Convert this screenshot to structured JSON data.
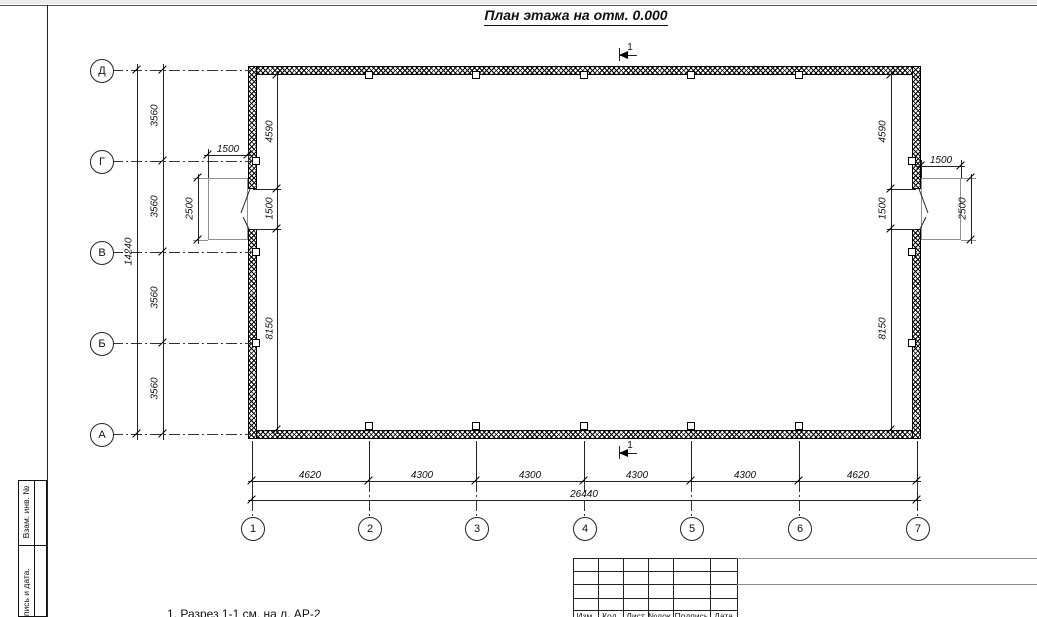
{
  "page": {
    "title": "План этажа на отм. 0.000",
    "note": "1. Разрез 1-1 см. на л. АР-2"
  },
  "section": {
    "label": "1"
  },
  "axes": {
    "rows": [
      "Д",
      "Г",
      "В",
      "Б",
      "А"
    ],
    "cols": [
      "1",
      "2",
      "3",
      "4",
      "5",
      "6",
      "7"
    ]
  },
  "dims": {
    "row_spacing": [
      "3560",
      "3560",
      "3560",
      "3560"
    ],
    "row_total": "14240",
    "col_spacing": [
      "4620",
      "4300",
      "4300",
      "4300",
      "4300",
      "4620"
    ],
    "col_total": "26440",
    "inner_left": [
      "4590",
      "1500",
      "8150"
    ],
    "inner_right": [
      "4590",
      "1500",
      "8150"
    ],
    "door_left": {
      "width": "1500",
      "swing": "2500"
    },
    "door_right": {
      "width": "1500",
      "swing": "2500"
    }
  },
  "stamp": {
    "headers": [
      "Изм.",
      "Кол.",
      "Лист",
      "№док.",
      "Подпись",
      "Дата"
    ]
  },
  "frame": {
    "labels": [
      "Взам. инв. №",
      "Подпись и дата."
    ]
  }
}
